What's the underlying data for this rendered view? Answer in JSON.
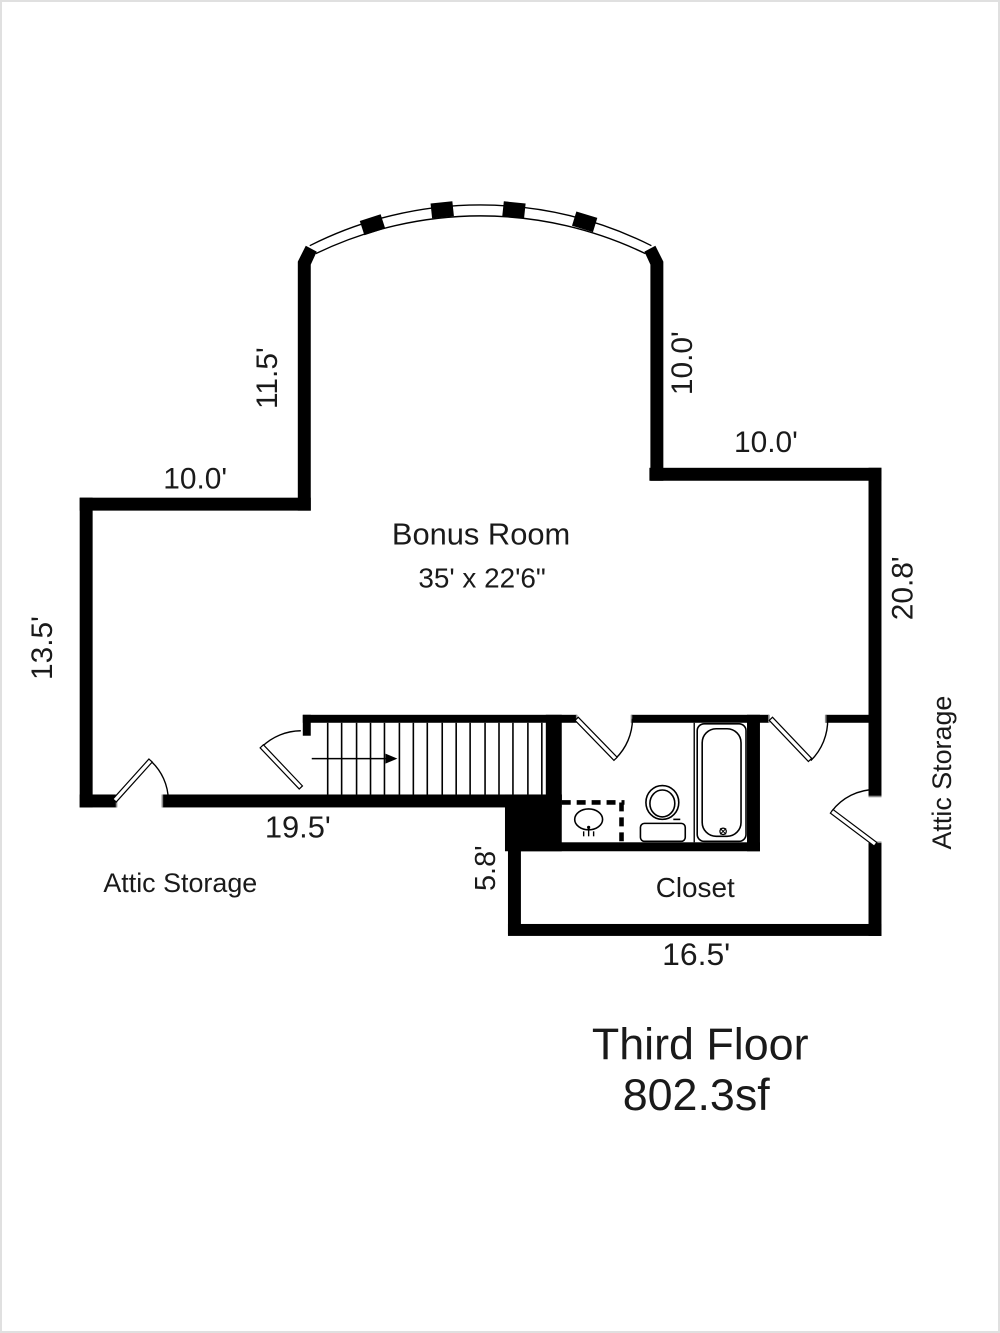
{
  "title": {
    "line1": "Third Floor",
    "line2": "802.3sf"
  },
  "rooms": {
    "bonus_room": {
      "name": "Bonus Room",
      "size": "35' x 22'6\""
    },
    "closet": {
      "name": "Closet"
    },
    "attic_storage_left": {
      "name": "Attic Storage"
    },
    "attic_storage_right": {
      "name": "Attic Storage"
    }
  },
  "dimensions": {
    "top_left_horizontal": "10.0'",
    "upper_left_vertical": "11.5'",
    "left_vertical": "13.5'",
    "upper_right_vertical": "10.0'",
    "top_right_horizontal": "10.0'",
    "right_vertical": "20.8'",
    "stair_wall_horizontal": "19.5'",
    "closet_left_vertical": "5.8'",
    "closet_bottom_horizontal": "16.5'"
  },
  "colors": {
    "wall": "#000000",
    "background": "#ffffff",
    "text": "#1a1a1a"
  }
}
